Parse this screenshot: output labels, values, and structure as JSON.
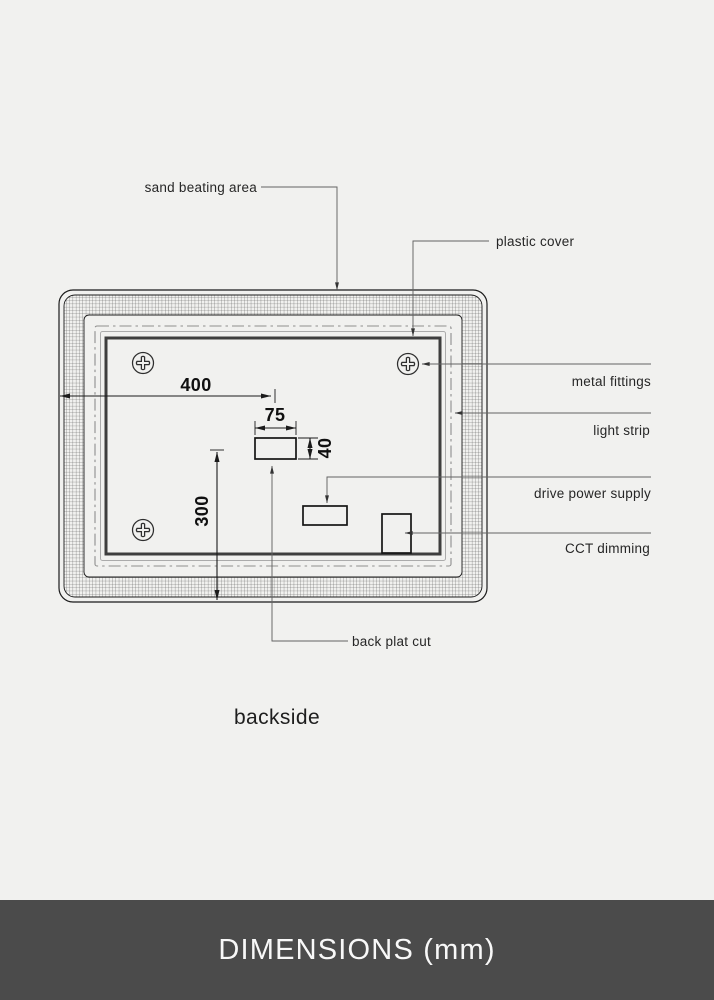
{
  "diagram": {
    "caption": "backside",
    "labels": {
      "sand_beating_area": "sand beating area",
      "plastic_cover": "plastic cover",
      "metal_fittings": "metal fittings",
      "light_strip": "light strip",
      "drive_power_supply": "drive power supply",
      "cct_dimming": "CCT dimming",
      "back_plat_cut": "back plat cut"
    },
    "dimensions": {
      "offset_from_left": "400",
      "cut_width": "75",
      "cut_height": "40",
      "offset_from_bottom": "300"
    },
    "colors": {
      "background": "#f1f1ef",
      "line": "#1b1b1b",
      "centerline_gray": "#8e8e8e",
      "inner_frame": "#3e3e3e"
    }
  },
  "footer": {
    "title": "DIMENSIONS (mm)",
    "bg": "#4b4b4b",
    "text_color": "#f8f8f8"
  }
}
